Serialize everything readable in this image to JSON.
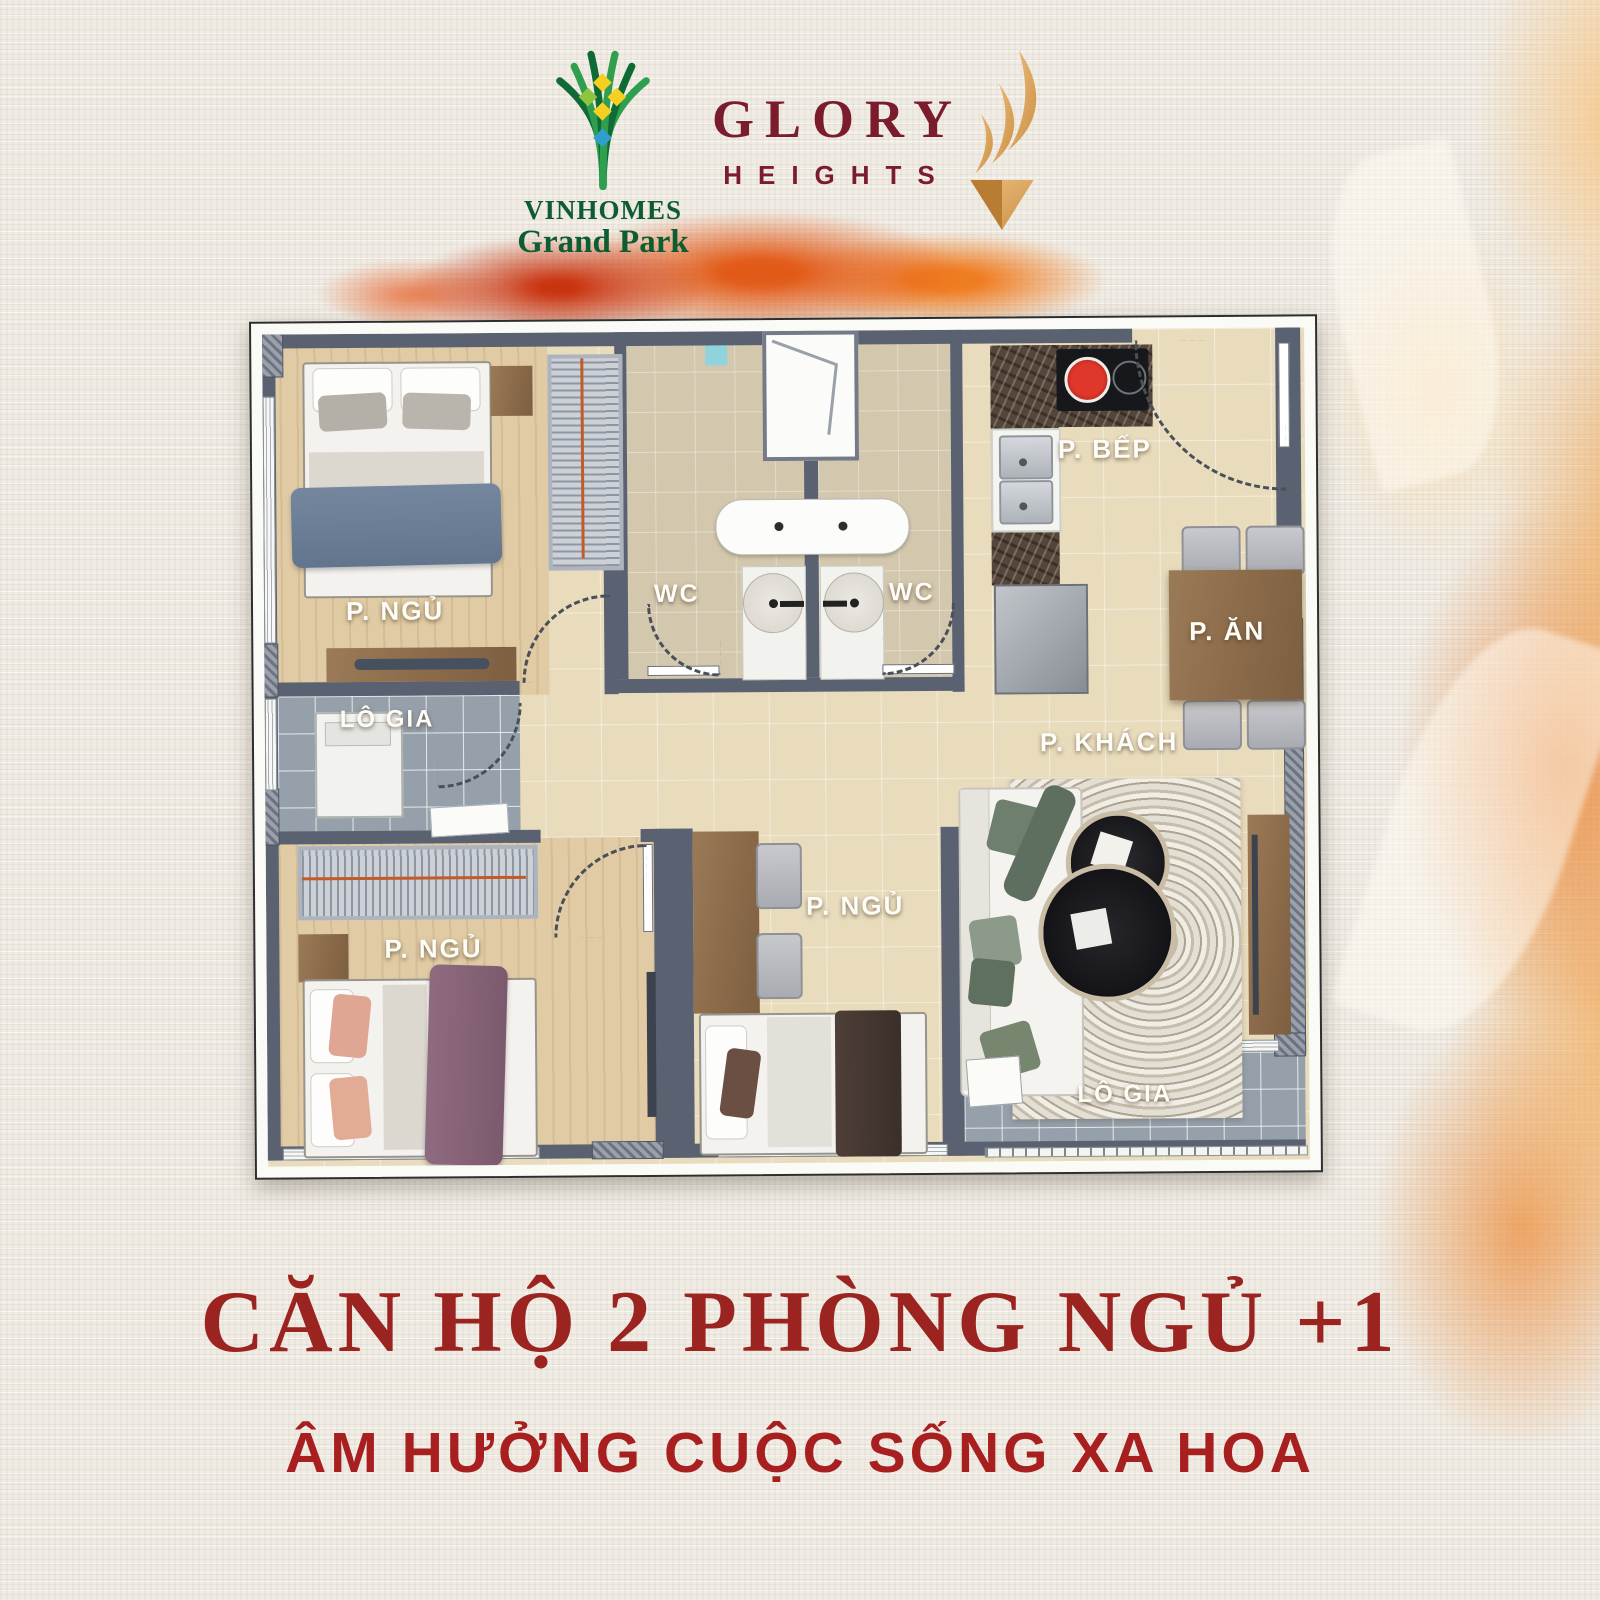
{
  "brand": {
    "vinhomes": {
      "name": "VINHOMES",
      "sub": "Grand Park"
    },
    "glory": {
      "name": "GLORY",
      "sub": "HEIGHTS"
    }
  },
  "icons": {
    "vinhomes_tree_icon": "woven green tree with yellow and blue diamonds",
    "glory_flame_icon": "gold flame swooshes over inverted pyramid"
  },
  "floorplan": {
    "rooms": {
      "bedroom_top_left": "P. NGỦ",
      "wc_left": "WC",
      "wc_right": "WC",
      "kitchen": "P. BẾP",
      "dining": "P. ĂN",
      "loggia_left": "LÔ GIA",
      "bedroom_bottom_left": "P. NGỦ",
      "bedroom_middle": "P. NGỦ",
      "living": "P. KHÁCH",
      "loggia_right": "LÔ GIA"
    }
  },
  "footer": {
    "headline": "CĂN HỘ 2 PHÒNG NGỦ +1",
    "subheadline": "ÂM HƯỞNG CUỘC SỐNG XA HOA"
  },
  "colors": {
    "headline_red": "#9b2420",
    "subheadline_red": "#a81f1f",
    "glory_maroon": "#7b1c2d",
    "vinhomes_green": "#0e5c32",
    "gold": "#dba55c",
    "wall_gray": "#5a6272",
    "splash_orange": "#e25a17"
  }
}
